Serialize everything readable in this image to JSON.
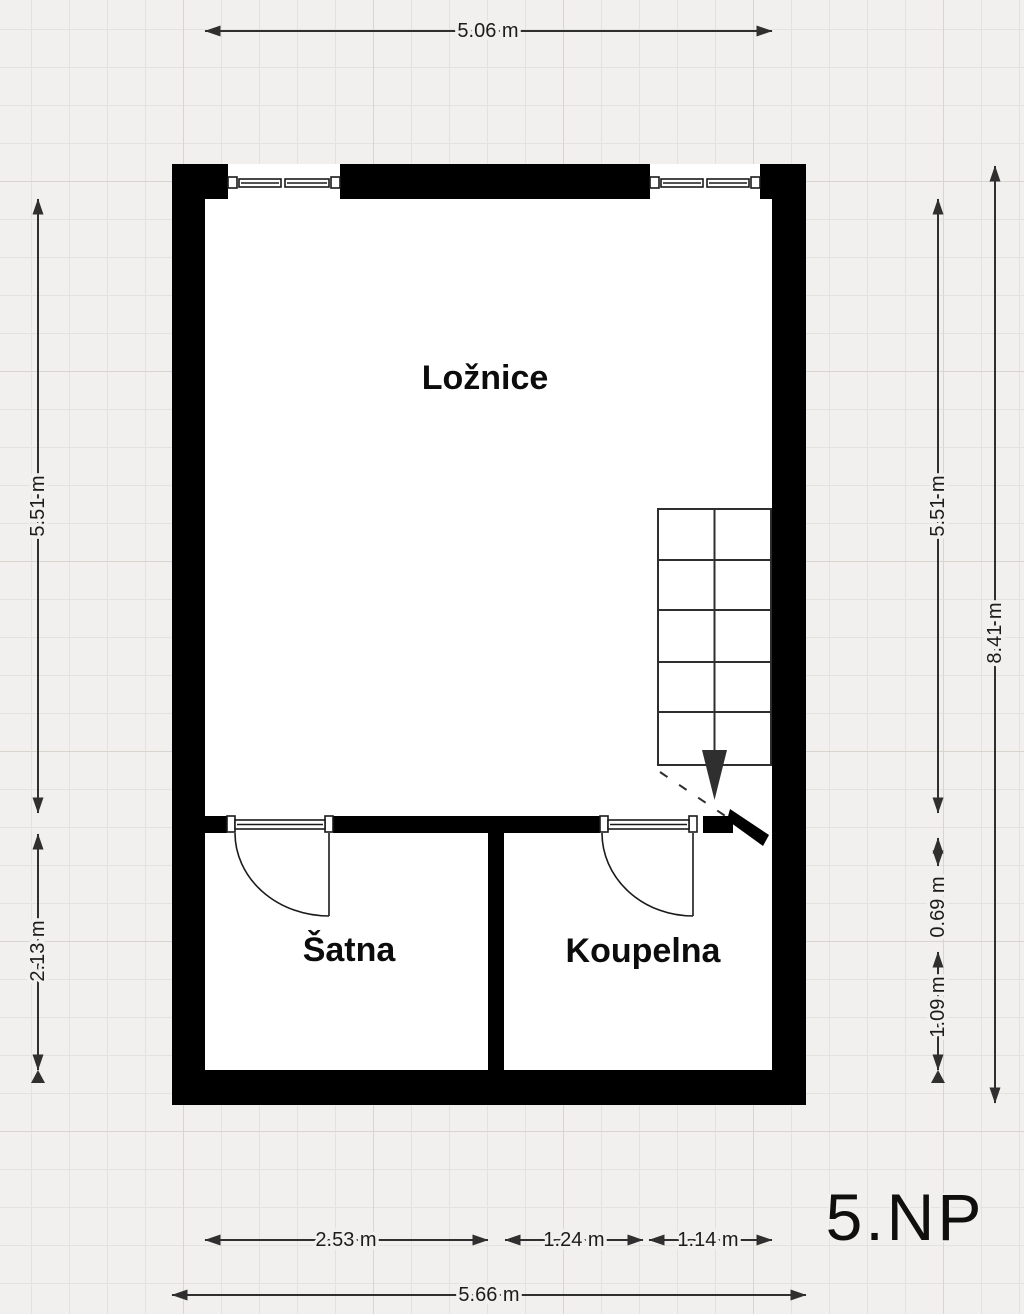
{
  "floor_plan": {
    "floor_label": "5.NP",
    "rooms": {
      "bedroom": "Ložnice",
      "closet": "Šatna",
      "bathroom": "Koupelna"
    },
    "dimensions": {
      "top_width": "5.06 m",
      "left_upper": "5.51 m",
      "left_lower": "2.13 m",
      "right_upper": "5.51 m",
      "right_mid": "0.69 m",
      "right_lower": "1.09 m",
      "right_total": "8.41 m",
      "bottom_closet": "2.53 m",
      "bottom_mid": "1.24 m",
      "bottom_right": "1.14 m",
      "bottom_total": "5.66 m"
    },
    "colors": {
      "wall": "#000000",
      "floor": "#ffffff",
      "background": "#f1f0ee",
      "grid_line": "#e4e2dd",
      "dimension_line": "#2f2f2f"
    }
  }
}
